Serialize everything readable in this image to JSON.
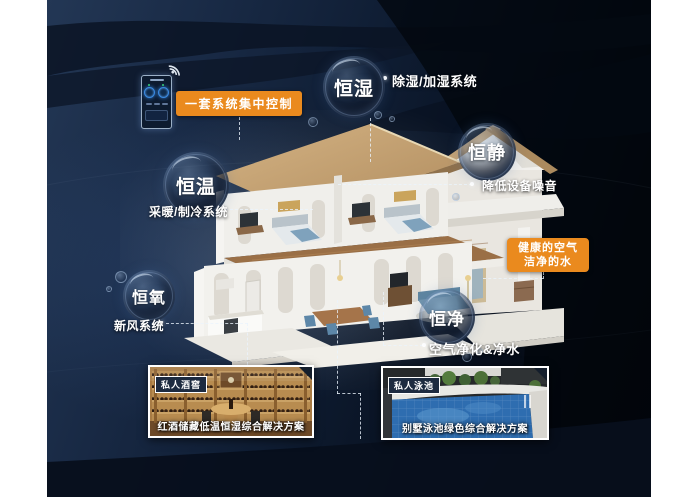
{
  "title": "smart-home constant-system infographic",
  "colors": {
    "accent_orange": "#ea8a1e",
    "panel_navy": "#13223b",
    "line_white": "#ffffff"
  },
  "control": {
    "label": "一套系统集中控制",
    "device": "smart-home-control-phone"
  },
  "features": [
    {
      "name": "恒湿",
      "annotation": "除湿/加湿系统"
    },
    {
      "name": "恒静",
      "annotation": "降低设备噪音"
    },
    {
      "name": "恒温",
      "annotation": "采暖/制冷系统"
    },
    {
      "name": "恒氧",
      "annotation": "新风系统"
    },
    {
      "name": "恒净",
      "annotation": "空气净化&净水"
    }
  ],
  "highlight": {
    "line1": "健康的空气",
    "line2": "洁净的水"
  },
  "cards": [
    {
      "badge": "私人酒窖",
      "caption": "红酒储藏低温恒湿综合解决方案",
      "scene": "wine-cellar"
    },
    {
      "badge": "私人泳池",
      "caption": "别墅泳池绿色综合解决方案",
      "scene": "villa-pool"
    }
  ]
}
